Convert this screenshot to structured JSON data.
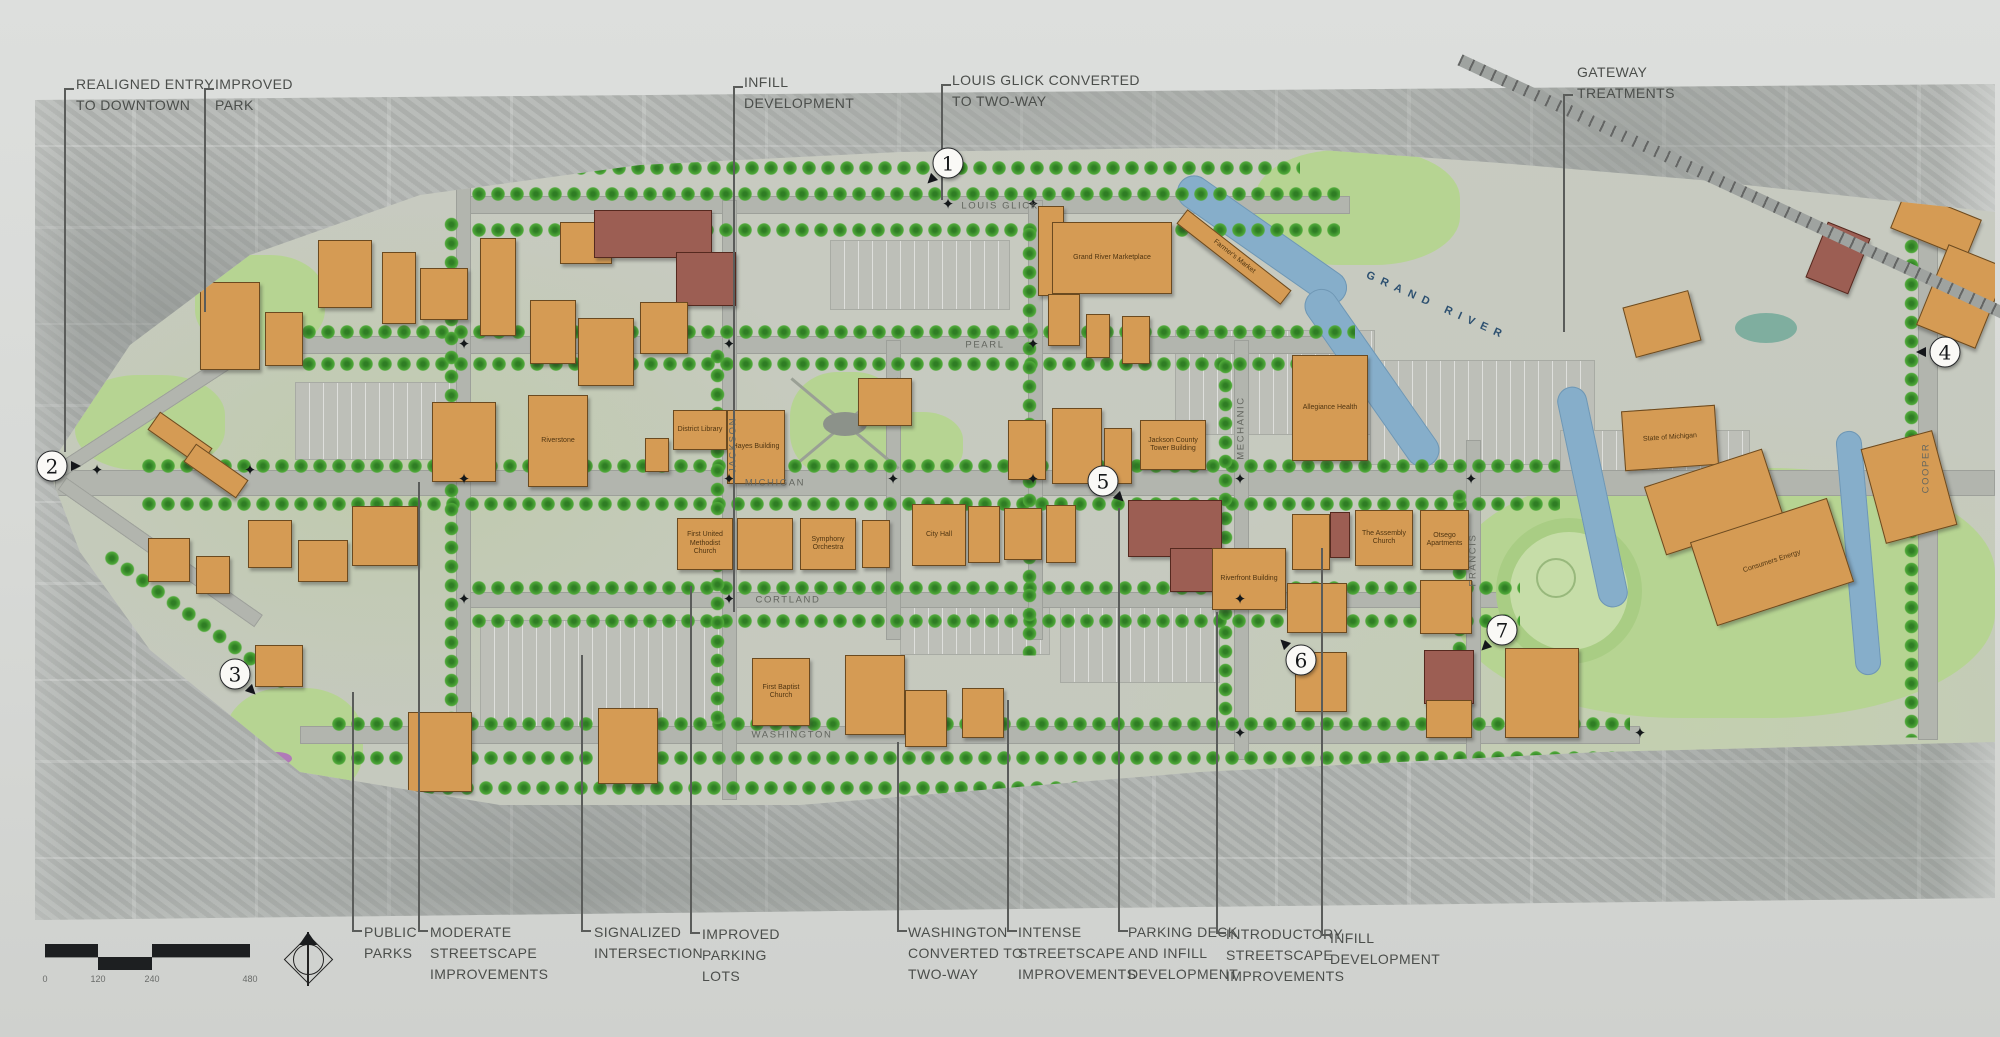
{
  "colors": {
    "building_orange": "#d59b54",
    "building_maroon": "#9c5e53",
    "river_blue": "#86aeca",
    "tree_green": "#4fa939",
    "lawn_green": "#b6d492",
    "label_gray": "#4b4e4b"
  },
  "top_callouts": [
    {
      "label": "REALIGNED ENTRY\nTO DOWNTOWN",
      "tx": 76,
      "ty": 74,
      "lx": 64,
      "lt": 88,
      "lb": 452
    },
    {
      "label": "IMPROVED\nPARK",
      "tx": 215,
      "ty": 74,
      "lx": 204,
      "lt": 88,
      "lb": 312
    },
    {
      "label": "INFILL\nDEVELOPMENT",
      "tx": 744,
      "ty": 72,
      "lx": 733,
      "lt": 86,
      "lb": 612
    },
    {
      "label": "LOUIS GLICK CONVERTED\nTO TWO-WAY",
      "tx": 952,
      "ty": 70,
      "lx": 941,
      "lt": 84,
      "lb": 200
    },
    {
      "label": "GATEWAY\nTREATMENTS",
      "tx": 1577,
      "ty": 62,
      "lx": 1563,
      "lt": 94,
      "lb": 332
    }
  ],
  "bottom_callouts": [
    {
      "label": "PUBLIC\nPARKS",
      "tx": 364,
      "ty": 922,
      "lx": 352,
      "lt": 692,
      "lb": 930
    },
    {
      "label": "MODERATE\nSTREETSCAPE\nIMPROVEMENTS",
      "tx": 430,
      "ty": 922,
      "lx": 418,
      "lt": 482,
      "lb": 930
    },
    {
      "label": "SIGNALIZED\nINTERSECTION",
      "tx": 594,
      "ty": 922,
      "lx": 581,
      "lt": 655,
      "lb": 930
    },
    {
      "label": "IMPROVED\nPARKING\nLOTS",
      "tx": 702,
      "ty": 924,
      "lx": 690,
      "lt": 586,
      "lb": 932
    },
    {
      "label": "WASHINGTON\nCONVERTED TO\nTWO-WAY",
      "tx": 908,
      "ty": 922,
      "lx": 897,
      "lt": 742,
      "lb": 930
    },
    {
      "label": "INTENSE\nSTREETSCAPE\nIMPROVEMENTS",
      "tx": 1018,
      "ty": 922,
      "lx": 1007,
      "lt": 700,
      "lb": 930
    },
    {
      "label": "PARKING DECK\nAND INFILL\nDEVELOPMENT",
      "tx": 1128,
      "ty": 922,
      "lx": 1118,
      "lt": 508,
      "lb": 930
    },
    {
      "label": "INTRODUCTORY\nSTREETSCAPE\nIMPROVEMENTS",
      "tx": 1226,
      "ty": 924,
      "lx": 1216,
      "lt": 612,
      "lb": 932
    },
    {
      "label": "INFILL\nDEVELOPMENT",
      "tx": 1330,
      "ty": 928,
      "lx": 1321,
      "lt": 548,
      "lb": 934
    }
  ],
  "markers": [
    {
      "n": "1",
      "x": 948,
      "y": 163,
      "dir": 135
    },
    {
      "n": "2",
      "x": 52,
      "y": 466,
      "dir": 0
    },
    {
      "n": "3",
      "x": 235,
      "y": 674,
      "dir": 45
    },
    {
      "n": "4",
      "x": 1945,
      "y": 352,
      "dir": 180
    },
    {
      "n": "5",
      "x": 1103,
      "y": 481,
      "dir": 45
    },
    {
      "n": "6",
      "x": 1301,
      "y": 660,
      "dir": 225
    },
    {
      "n": "7",
      "x": 1502,
      "y": 630,
      "dir": 135
    }
  ],
  "street_labels": [
    {
      "t": "LOUIS GLICK",
      "x": 1000,
      "y": 206,
      "v": 0
    },
    {
      "t": "PEARL",
      "x": 985,
      "y": 345,
      "v": 0
    },
    {
      "t": "MICHIGAN",
      "x": 775,
      "y": 483,
      "v": 0
    },
    {
      "t": "CORTLAND",
      "x": 788,
      "y": 600,
      "v": 0
    },
    {
      "t": "WASHINGTON",
      "x": 792,
      "y": 735,
      "v": 0
    },
    {
      "t": "JACKSON",
      "x": 733,
      "y": 445,
      "v": 1
    },
    {
      "t": "MECHANIC",
      "x": 1241,
      "y": 428,
      "v": 1
    },
    {
      "t": "FRANCIS",
      "x": 1473,
      "y": 560,
      "v": 1
    },
    {
      "t": "COOPER",
      "x": 1926,
      "y": 468,
      "v": 1
    }
  ],
  "river_label": {
    "t": "GRAND RIVER",
    "x": 1360,
    "y": 300,
    "rot": 24
  },
  "buildings": [
    [
      318,
      240,
      52,
      66,
      "o",
      0,
      ""
    ],
    [
      382,
      252,
      32,
      70,
      "o",
      0,
      ""
    ],
    [
      420,
      268,
      46,
      50,
      "o",
      0,
      ""
    ],
    [
      480,
      238,
      34,
      96,
      "o",
      0,
      ""
    ],
    [
      560,
      222,
      50,
      40,
      "o",
      0,
      ""
    ],
    [
      594,
      210,
      116,
      46,
      "m",
      0,
      ""
    ],
    [
      676,
      252,
      58,
      52,
      "m",
      0,
      ""
    ],
    [
      530,
      300,
      44,
      62,
      "o",
      0,
      ""
    ],
    [
      578,
      318,
      54,
      66,
      "o",
      0,
      ""
    ],
    [
      640,
      302,
      46,
      50,
      "o",
      0,
      ""
    ],
    [
      200,
      282,
      58,
      86,
      "o",
      0,
      ""
    ],
    [
      265,
      312,
      36,
      52,
      "o",
      0,
      ""
    ],
    [
      148,
      428,
      62,
      20,
      "o",
      35,
      ""
    ],
    [
      184,
      460,
      62,
      20,
      "o",
      35,
      ""
    ],
    [
      1038,
      206,
      24,
      88,
      "o",
      0,
      ""
    ],
    [
      1052,
      222,
      118,
      70,
      "o",
      0,
      "Grand River Marketplace"
    ],
    [
      1048,
      294,
      30,
      50,
      "o",
      0,
      ""
    ],
    [
      1086,
      314,
      22,
      42,
      "o",
      0,
      ""
    ],
    [
      1122,
      316,
      26,
      46,
      "o",
      0,
      ""
    ],
    [
      1168,
      248,
      130,
      16,
      "o",
      38,
      "Farmer's Market"
    ],
    [
      858,
      378,
      52,
      46,
      "o",
      0,
      ""
    ],
    [
      432,
      402,
      62,
      78,
      "o",
      0,
      ""
    ],
    [
      528,
      395,
      58,
      90,
      "o",
      0,
      "Riverstone"
    ],
    [
      645,
      438,
      22,
      32,
      "o",
      0,
      ""
    ],
    [
      673,
      410,
      52,
      38,
      "o",
      0,
      "District Library"
    ],
    [
      727,
      410,
      56,
      72,
      "o",
      0,
      "Hayes Building"
    ],
    [
      148,
      538,
      40,
      42,
      "o",
      0,
      ""
    ],
    [
      196,
      556,
      32,
      36,
      "o",
      0,
      ""
    ],
    [
      248,
      520,
      42,
      46,
      "o",
      0,
      ""
    ],
    [
      298,
      540,
      48,
      40,
      "o",
      0,
      ""
    ],
    [
      352,
      506,
      64,
      58,
      "o",
      0,
      ""
    ],
    [
      255,
      645,
      46,
      40,
      "o",
      0,
      ""
    ],
    [
      408,
      712,
      62,
      78,
      "o",
      0,
      ""
    ],
    [
      598,
      708,
      58,
      74,
      "o",
      0,
      ""
    ],
    [
      677,
      518,
      54,
      50,
      "o",
      0,
      "First United Methodist Church"
    ],
    [
      737,
      518,
      54,
      50,
      "o",
      0,
      ""
    ],
    [
      800,
      518,
      54,
      50,
      "o",
      0,
      "Symphony Orchestra"
    ],
    [
      862,
      520,
      26,
      46,
      "o",
      0,
      ""
    ],
    [
      912,
      504,
      52,
      60,
      "o",
      0,
      "City Hall"
    ],
    [
      968,
      506,
      30,
      55,
      "o",
      0,
      ""
    ],
    [
      1004,
      508,
      36,
      50,
      "o",
      0,
      ""
    ],
    [
      1046,
      505,
      28,
      56,
      "o",
      0,
      ""
    ],
    [
      1128,
      500,
      92,
      55,
      "m",
      0,
      ""
    ],
    [
      1170,
      548,
      112,
      42,
      "m",
      0,
      ""
    ],
    [
      1008,
      420,
      36,
      58,
      "o",
      0,
      ""
    ],
    [
      1052,
      408,
      48,
      74,
      "o",
      0,
      ""
    ],
    [
      1104,
      428,
      26,
      54,
      "o",
      0,
      ""
    ],
    [
      1140,
      420,
      64,
      48,
      "o",
      0,
      "Jackson County Tower Building"
    ],
    [
      1292,
      355,
      74,
      104,
      "o",
      0,
      "Allegiance Health"
    ],
    [
      1623,
      408,
      92,
      58,
      "o",
      -4,
      "State of Michigan"
    ],
    [
      1292,
      514,
      36,
      54,
      "o",
      0,
      ""
    ],
    [
      1330,
      512,
      18,
      44,
      "m",
      0,
      ""
    ],
    [
      1355,
      510,
      56,
      54,
      "o",
      0,
      "The Assembly Church"
    ],
    [
      1420,
      510,
      47,
      58,
      "o",
      0,
      "Otsego Apartments"
    ],
    [
      1212,
      548,
      72,
      60,
      "o",
      0,
      "Riverfront Building"
    ],
    [
      752,
      658,
      56,
      66,
      "o",
      0,
      "First Baptist Church"
    ],
    [
      845,
      655,
      58,
      78,
      "o",
      0,
      ""
    ],
    [
      905,
      690,
      40,
      55,
      "o",
      0,
      ""
    ],
    [
      962,
      688,
      40,
      48,
      "o",
      0,
      ""
    ],
    [
      1287,
      583,
      58,
      48,
      "o",
      0,
      ""
    ],
    [
      1295,
      652,
      50,
      58,
      "o",
      0,
      ""
    ],
    [
      1420,
      580,
      50,
      52,
      "o",
      0,
      ""
    ],
    [
      1424,
      650,
      48,
      52,
      "m",
      0,
      ""
    ],
    [
      1426,
      700,
      44,
      36,
      "o",
      0,
      ""
    ],
    [
      1505,
      648,
      72,
      88,
      "o",
      0,
      ""
    ],
    [
      1652,
      466,
      122,
      70,
      "o",
      -18,
      ""
    ],
    [
      1700,
      518,
      142,
      86,
      "o",
      -18,
      "Consumers Energy"
    ],
    [
      1872,
      438,
      72,
      96,
      "o",
      -15,
      ""
    ],
    [
      1895,
      203,
      80,
      40,
      "o",
      22,
      ""
    ],
    [
      1930,
      253,
      62,
      85,
      "o",
      22,
      ""
    ],
    [
      1815,
      228,
      44,
      58,
      "m",
      22,
      ""
    ],
    [
      1628,
      298,
      66,
      50,
      "o",
      -15,
      ""
    ]
  ],
  "scale": {
    "ticks": [
      "0",
      "120",
      "240",
      "480"
    ]
  }
}
